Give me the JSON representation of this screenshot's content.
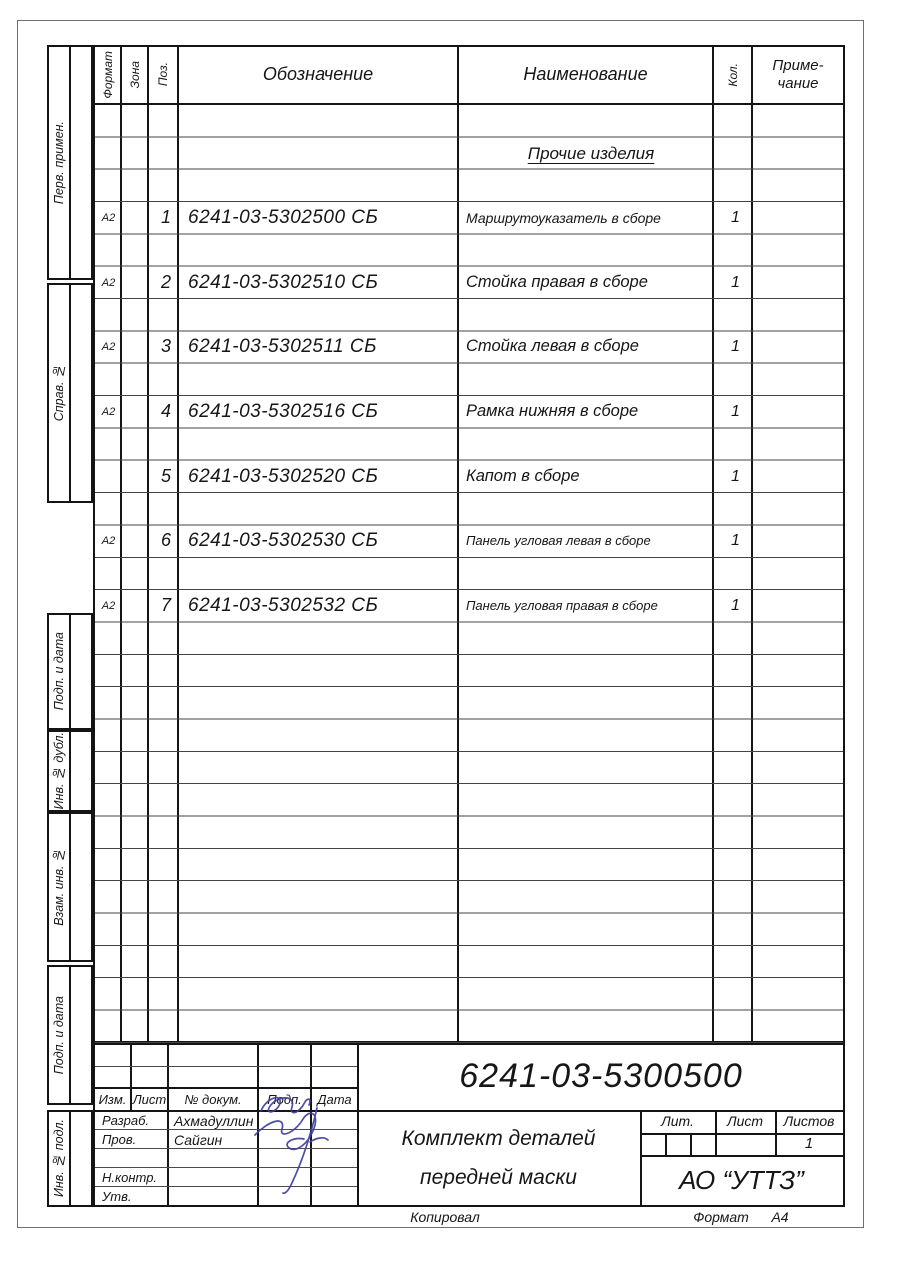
{
  "spec_table": {
    "headers": {
      "format": "Формат",
      "zone": "Зона",
      "pos": "Поз.",
      "designation": "Обозначение",
      "name": "Наименование",
      "qty": "Кол.",
      "note_line1": "Приме-",
      "note_line2": "чание"
    },
    "section_title": "Прочие изделия",
    "rows": [
      {
        "format": "А2",
        "pos": "1",
        "designation": "6241-03-5302500 СБ",
        "name": "Маршрутоуказатель в сборе",
        "qty": "1"
      },
      {
        "format": "А2",
        "pos": "2",
        "designation": "6241-03-5302510 СБ",
        "name": "Стойка правая в сборе",
        "qty": "1"
      },
      {
        "format": "А2",
        "pos": "3",
        "designation": "6241-03-5302511 СБ",
        "name": "Стойка левая в сборе",
        "qty": "1"
      },
      {
        "format": "А2",
        "pos": "4",
        "designation": "6241-03-5302516 СБ",
        "name": "Рамка нижняя в сборе",
        "qty": "1"
      },
      {
        "format": "",
        "pos": "5",
        "designation": "6241-03-5302520 СБ",
        "name": "Капот в сборе",
        "qty": "1"
      },
      {
        "format": "А2",
        "pos": "6",
        "designation": "6241-03-5302530 СБ",
        "name": "Панель угловая левая в сборе",
        "qty": "1"
      },
      {
        "format": "А2",
        "pos": "7",
        "designation": "6241-03-5302532 СБ",
        "name": "Панель угловая правая в сборе",
        "qty": "1"
      }
    ]
  },
  "side_stamps": [
    "Перв. примен.",
    "Справ. №",
    "Подп. и дата",
    "Инв. № дубл.",
    "Взам. инв. №",
    "Подп. и дата",
    "Инв. № подл."
  ],
  "title_block": {
    "doc_number": "6241-03-5300500",
    "rev_headers": [
      "Изм.",
      "Лист",
      "№ докум.",
      "Подп.",
      "Дата"
    ],
    "roles": [
      {
        "label": "Разраб.",
        "name": "Ахмадуллин"
      },
      {
        "label": "Пров.",
        "name": "Сайгин"
      },
      {
        "label": "",
        "name": ""
      },
      {
        "label": "Н.контр.",
        "name": ""
      },
      {
        "label": "Утв.",
        "name": ""
      }
    ],
    "title_line1": "Комплект деталей",
    "title_line2": "передней маски",
    "lit_label": "Лит.",
    "sheet_label": "Лист",
    "sheets_label": "Листов",
    "sheets_value": "1",
    "company": "АО “УТТЗ”"
  },
  "footer": {
    "copied": "Копировал",
    "format_label": "Формат",
    "format_value": "А4"
  },
  "colors": {
    "ink": "#151515",
    "signature": "#3f3f9f",
    "paper": "#ffffff"
  }
}
